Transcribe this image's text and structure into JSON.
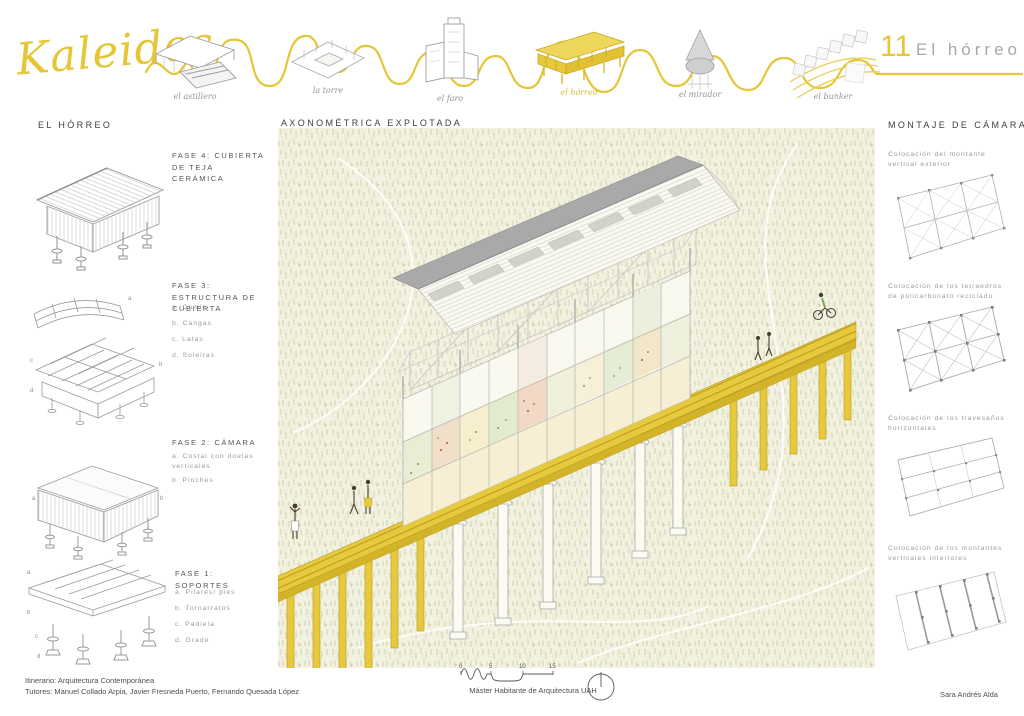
{
  "header": {
    "logo_text": "Kaleidos",
    "sheet_number": "11",
    "sheet_title": "El hórreo",
    "projects": [
      {
        "label": "el astillero",
        "highlighted": false
      },
      {
        "label": "la torre",
        "highlighted": false
      },
      {
        "label": "el faro",
        "highlighted": false
      },
      {
        "label": "el hórreo",
        "highlighted": true
      },
      {
        "label": "el mirador",
        "highlighted": false
      },
      {
        "label": "el bunker",
        "highlighted": false
      }
    ]
  },
  "left_panel": {
    "title": "EL HÓRREO",
    "phases": [
      {
        "title": "FASE 4: CUBIERTA DE TEJA CERÁMICA",
        "items": [],
        "markers": []
      },
      {
        "title": "FASE 3: ESTRUCTURA DE CUBIERTA",
        "items": [
          "a. Cumio",
          "b. Cangas",
          "c. Latas",
          "d. Soleiras"
        ],
        "markers": [
          "a",
          "b",
          "c",
          "d"
        ]
      },
      {
        "title": "FASE 2: CÁMARA",
        "items": [
          "a. Costal con doelas verticales",
          "b. Pinches"
        ],
        "markers": [
          "a",
          "b"
        ]
      },
      {
        "title": "FASE 1: SOPORTES",
        "items": [
          "a. Pilares/ pies",
          "b. Tornarratos",
          "c. Padiela",
          "d. Grade"
        ],
        "markers": [
          "a",
          "b",
          "c",
          "d"
        ]
      }
    ]
  },
  "center_panel": {
    "title": "AXONOMÉTRICA EXPLOTADA"
  },
  "right_panel": {
    "title": "MONTAJE DE CÁMARA",
    "steps": [
      {
        "caption": "Colocación del montante vertical exterior"
      },
      {
        "caption": "Colocación de los tetraedros de policarbonato reciclado"
      },
      {
        "caption": "Colocación de los travesaños horizontales"
      },
      {
        "caption": "Colocación de los montantes verticales interiores"
      }
    ]
  },
  "footer": {
    "itinerary": "Itinerario: Arquitectura Contemporánea",
    "tutors": "Tutores: Manuel Collado Arpia, Javier Fresneda Puerto, Fernando Quesada López",
    "program": "Máster Habitante de Arquitectura UAH",
    "author": "Sara Andrés Alda",
    "scale_ticks": [
      "0",
      "5",
      "10",
      "15"
    ]
  },
  "colors": {
    "accent_yellow": "#e4c636",
    "walkway_yellow": "#e7c93e",
    "roof_gray": "#a9a9a9",
    "field_base": "#f3f2e1",
    "speckle_pink": "#e2a69e"
  }
}
